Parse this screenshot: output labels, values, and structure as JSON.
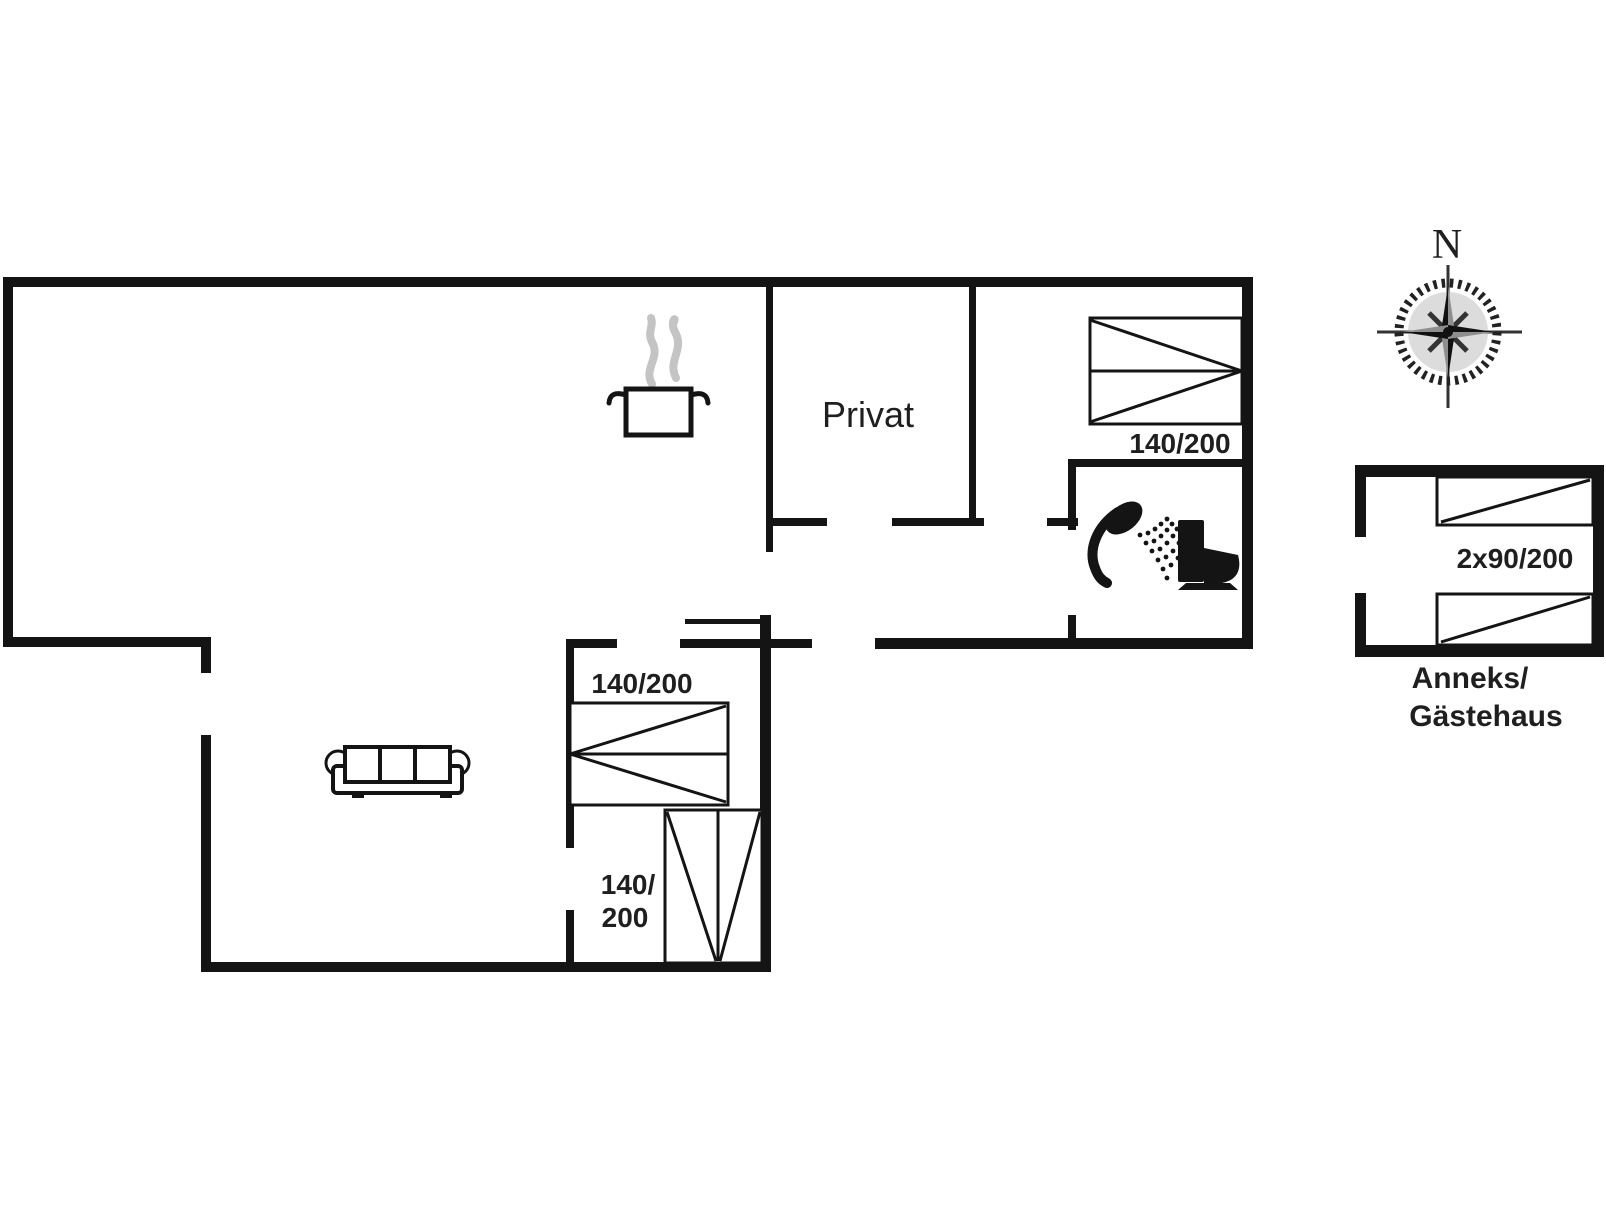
{
  "floor_plan": {
    "room_labels": {
      "private": "Privat"
    },
    "bed_labels": {
      "bedroom_top_right": "140/200",
      "bedroom_middle": "140/200",
      "bedroom_bottom_line1": "140/",
      "bedroom_bottom_line2": "200"
    },
    "annex": {
      "bed_label": "2x90/200",
      "name_line1": "Anneks/",
      "name_line2": "Gästehaus"
    },
    "compass": {
      "north": "N"
    },
    "icons": {
      "kitchen": "cooking-pot-icon",
      "living": "sofa-icon",
      "bathroom": [
        "shower-icon",
        "toilet-icon"
      ],
      "orientation": "compass-rose-icon"
    },
    "colors": {
      "wall": "#141414",
      "text": "#1f1f1f",
      "steam": "#c4c4c4",
      "background": "#ffffff"
    }
  }
}
